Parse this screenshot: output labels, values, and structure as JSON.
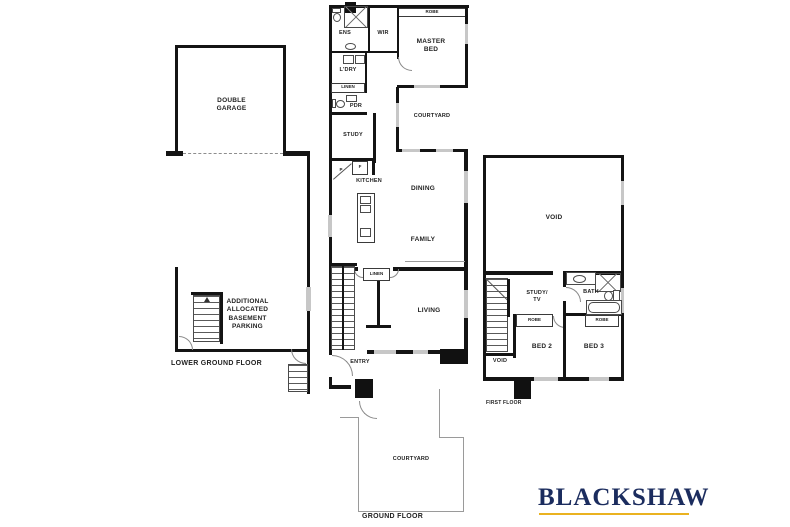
{
  "floors": {
    "lower_ground": {
      "label": "LOWER GROUND FLOOR",
      "garage": "DOUBLE\nGARAGE",
      "parking": "ADDITIONAL\nALLOCATED\nBASEMENT\nPARKING"
    },
    "ground": {
      "label": "GROUND FLOOR",
      "ens": "ENS",
      "wir": "WIR",
      "robe": "ROBE",
      "master_bed": "MASTER\nBED",
      "ldry": "L'DRY",
      "linen_top": "LINEN",
      "pdr": "PDR",
      "study": "STUDY",
      "courtyard_upper": "COURTYARD",
      "pantry": "P",
      "fridge": "F",
      "kitchen": "KITCHEN",
      "dining": "DINING",
      "family": "FAMILY",
      "linen_mid": "LINEN",
      "living": "LIVING",
      "entry": "ENTRY",
      "courtyard_lower": "COURTYARD"
    },
    "first": {
      "label": "FIRST FLOOR",
      "void_main": "VOID",
      "study_tv": "STUDY/\nTV",
      "bath": "BATH",
      "robe_bed2": "ROBE",
      "robe_bed3": "ROBE",
      "bed2": "BED 2",
      "bed3": "BED 3",
      "void_small": "VOID"
    }
  },
  "brand": {
    "name": "BLACKSHAW",
    "text_color": "#1b2c5e",
    "underline_color": "#eab220"
  }
}
